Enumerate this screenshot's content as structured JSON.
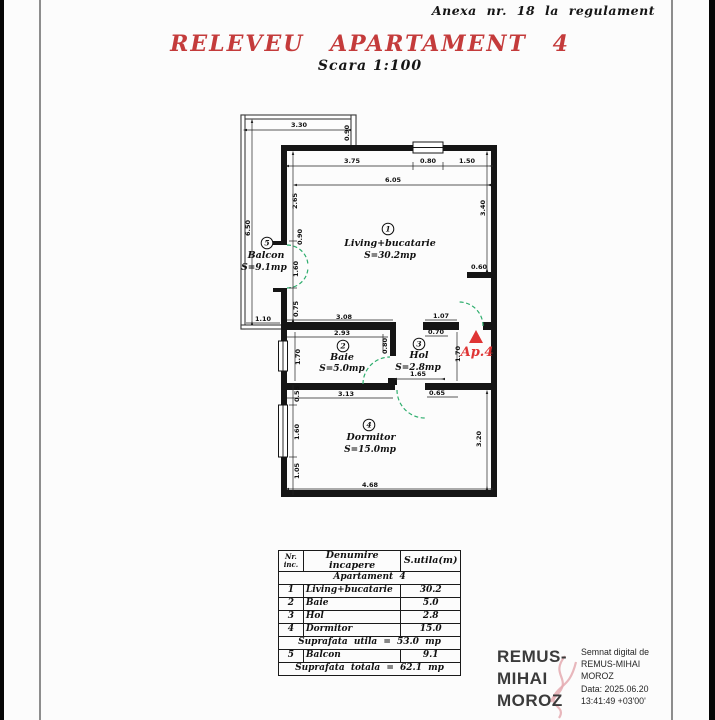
{
  "page": {
    "annotation": "Anexa nr. 18 la regulament",
    "title": "RELEVEU APARTAMENT 4",
    "scale": "Scara 1:100"
  },
  "plan": {
    "entrance_label": "Ap.4",
    "rooms": [
      {
        "num": "1",
        "name": "Living+bucatarie",
        "area": "S=30.2mp",
        "cx": 388,
        "cy": 229,
        "nx": 390,
        "ny": 246,
        "ax": 390,
        "ay": 258
      },
      {
        "num": "2",
        "name": "Baie",
        "area": "S=5.0mp",
        "cx": 343,
        "cy": 346,
        "nx": 342,
        "ny": 360,
        "ax": 342,
        "ay": 371
      },
      {
        "num": "3",
        "name": "Hol",
        "area": "S=2.8mp",
        "cx": 419,
        "cy": 344,
        "nx": 419,
        "ny": 358,
        "ax": 418,
        "ay": 370
      },
      {
        "num": "4",
        "name": "Dormitor",
        "area": "S=15.0mp",
        "cx": 369,
        "cy": 425,
        "nx": 371,
        "ny": 440,
        "ax": 370,
        "ay": 452
      },
      {
        "num": "5",
        "name": "Balcon",
        "area": "S=9.1mp",
        "cx": 267,
        "cy": 243,
        "nx": 266,
        "ny": 258,
        "ax": 264,
        "ay": 270
      }
    ],
    "dimensions": [
      {
        "v": "3.30",
        "x": 299,
        "y": 127
      },
      {
        "v": "0.90",
        "x": 349,
        "y": 133,
        "r": 1
      },
      {
        "v": "6.50",
        "x": 250,
        "y": 228,
        "r": 1
      },
      {
        "v": "1.10",
        "x": 263,
        "y": 321
      },
      {
        "v": "3.75",
        "x": 352,
        "y": 163
      },
      {
        "v": "0.80",
        "x": 428,
        "y": 163
      },
      {
        "v": "1.50",
        "x": 467,
        "y": 163
      },
      {
        "v": "6.05",
        "x": 393,
        "y": 182
      },
      {
        "v": "2.65",
        "x": 297,
        "y": 201,
        "r": 1
      },
      {
        "v": "0.90",
        "x": 302,
        "y": 237,
        "r": 1
      },
      {
        "v": "1.60",
        "x": 298,
        "y": 269,
        "r": 1
      },
      {
        "v": "0.75",
        "x": 298,
        "y": 309,
        "r": 1
      },
      {
        "v": "3.40",
        "x": 485,
        "y": 208,
        "r": 1
      },
      {
        "v": "0.60",
        "x": 479,
        "y": 269
      },
      {
        "v": "3.08",
        "x": 344,
        "y": 319
      },
      {
        "v": "1.07",
        "x": 441,
        "y": 318
      },
      {
        "v": "2.93",
        "x": 342,
        "y": 335
      },
      {
        "v": "0.70",
        "x": 436,
        "y": 334
      },
      {
        "v": "1.70",
        "x": 300,
        "y": 357,
        "r": 1
      },
      {
        "v": "0.80",
        "x": 387,
        "y": 346,
        "r": 1
      },
      {
        "v": "1.70",
        "x": 460,
        "y": 354,
        "r": 1
      },
      {
        "v": "1.65",
        "x": 418,
        "y": 376
      },
      {
        "v": "3.13",
        "x": 346,
        "y": 396
      },
      {
        "v": "0.65",
        "x": 437,
        "y": 395
      },
      {
        "v": "0.55",
        "x": 299,
        "y": 394,
        "r": 1
      },
      {
        "v": "1.60",
        "x": 299,
        "y": 432,
        "r": 1
      },
      {
        "v": "1.05",
        "x": 299,
        "y": 471,
        "r": 1
      },
      {
        "v": "3.20",
        "x": 481,
        "y": 439,
        "r": 1
      },
      {
        "v": "4.68",
        "x": 370,
        "y": 487
      }
    ],
    "colors": {
      "walls": "#151515",
      "door_arc": "#2fae6e",
      "entrance_red": "#df3434",
      "title_red": "#c43b3b"
    }
  },
  "table": {
    "headers": {
      "col1a": "Nr.",
      "col1b": "inc.",
      "col2": "Denumire incapere",
      "col3": "S.utila(m)"
    },
    "group_row": "Apartament 4",
    "rows": [
      [
        "1",
        "Living+bucatarie",
        "30.2"
      ],
      [
        "2",
        "Baie",
        "5.0"
      ],
      [
        "3",
        "Hol",
        "2.8"
      ],
      [
        "4",
        "Dormitor",
        "15.0"
      ]
    ],
    "subtotal": "Suprafata utila = 53.0 mp",
    "balcony_row": [
      "5",
      "Balcon",
      "9.1"
    ],
    "total": "Suprafata totala = 62.1 mp"
  },
  "signature": {
    "name_lines": [
      "REMUS-",
      "MIHAI",
      "MOROZ"
    ],
    "details": [
      "Semnat digital de",
      "REMUS-MIHAI",
      "MOROZ",
      "Data: 2025.06.20",
      "13:41:49 +03'00'"
    ]
  }
}
